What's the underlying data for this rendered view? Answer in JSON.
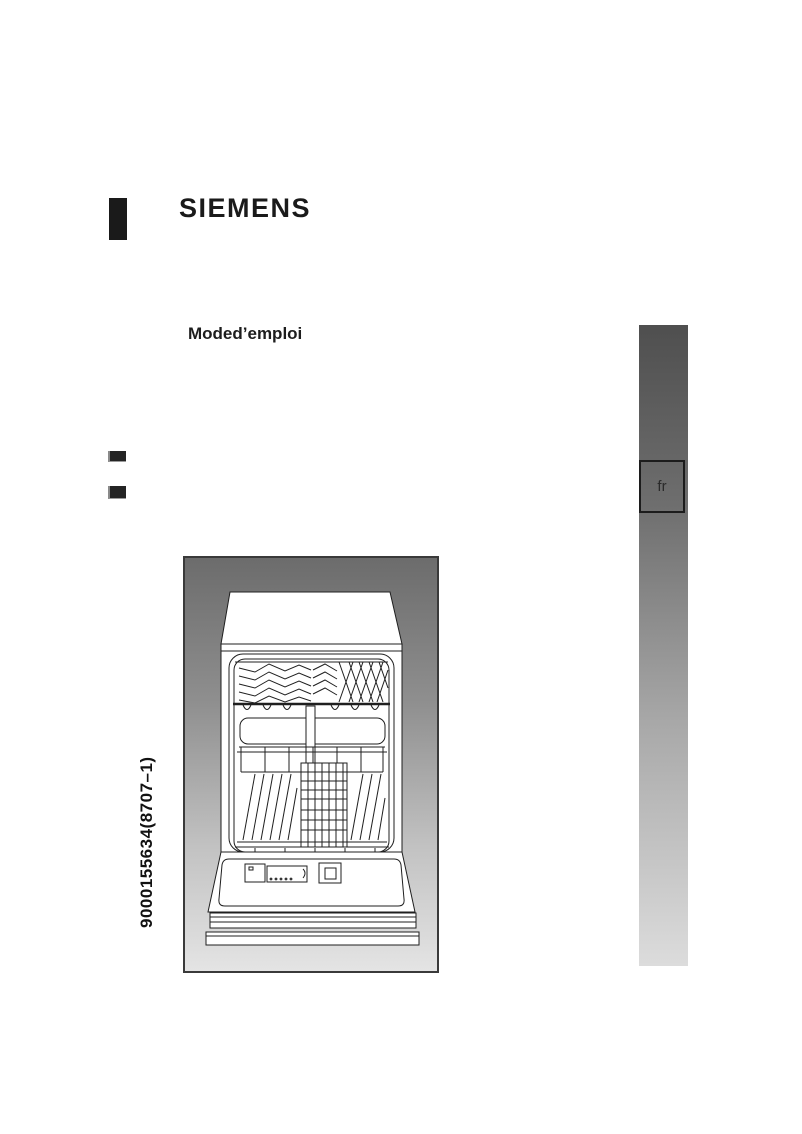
{
  "document": {
    "brand": "SIEMENS",
    "subtitle": "Moded’emploi",
    "language_tab": "fr",
    "order_code": "9000155634(8707–1)"
  },
  "colors": {
    "text": "#1a1a1a",
    "logo_bar": "#1a1a1a",
    "sidebar_gradient_top": "#4f4f4f",
    "sidebar_gradient_bottom": "#dcdcdc",
    "illustration_gradient_top": "#6c6c6c",
    "illustration_gradient_bottom": "#e4e4e4",
    "line_art": "#1f1f1f"
  },
  "illustration": {
    "name": "open-dishwasher-line-drawing",
    "description": "front view of an open dishwasher with upper and lower baskets and open door"
  }
}
